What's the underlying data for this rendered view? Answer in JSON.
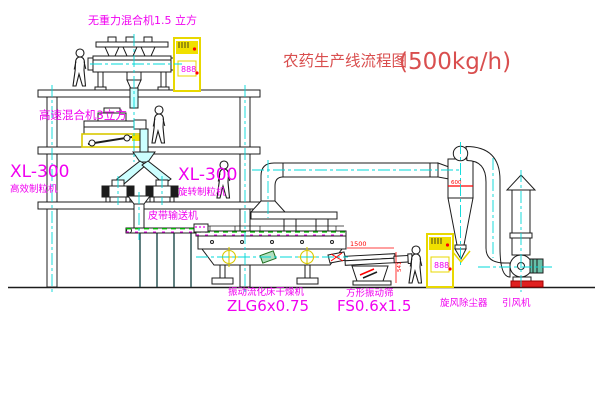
{
  "title": {
    "name": "农药生产线流程图",
    "capacity": "(500kg/h)"
  },
  "equipment": {
    "gravity_mixer": {
      "label": "无重力混合机1.5 立方"
    },
    "high_speed_mixer": {
      "label": "高速混合机3立方"
    },
    "granulator_left": {
      "model": "XL-300",
      "name": "高效制粒机"
    },
    "granulator_right": {
      "model": "XL-300",
      "name": "旋转制粒机"
    },
    "belt_conveyor": {
      "name": "皮带输送机"
    },
    "fluid_bed_dryer": {
      "name": "振动流化床干燥机",
      "model": "ZLG6x0.75"
    },
    "square_sieve": {
      "name": "方形振动筛",
      "model": "FS0.6x1.5"
    },
    "cyclone": {
      "name": "旋风除尘器"
    },
    "induced_draft_fan": {
      "name": "引风机"
    }
  },
  "dimensions": {
    "cyclone_inlet": "600",
    "sieve_length": "1500",
    "sieve_height": "541"
  },
  "control_cabinet": {
    "display": "888"
  },
  "colors": {
    "line": "#1c1c1c",
    "centerline": "#00d8d8",
    "label": "#f000f0",
    "title": "#d94f4f",
    "dimension": "#ff0000",
    "equipment_accent": "#f0e000",
    "belt_green": "#00b400",
    "pipe_fill": "#ccffff"
  }
}
